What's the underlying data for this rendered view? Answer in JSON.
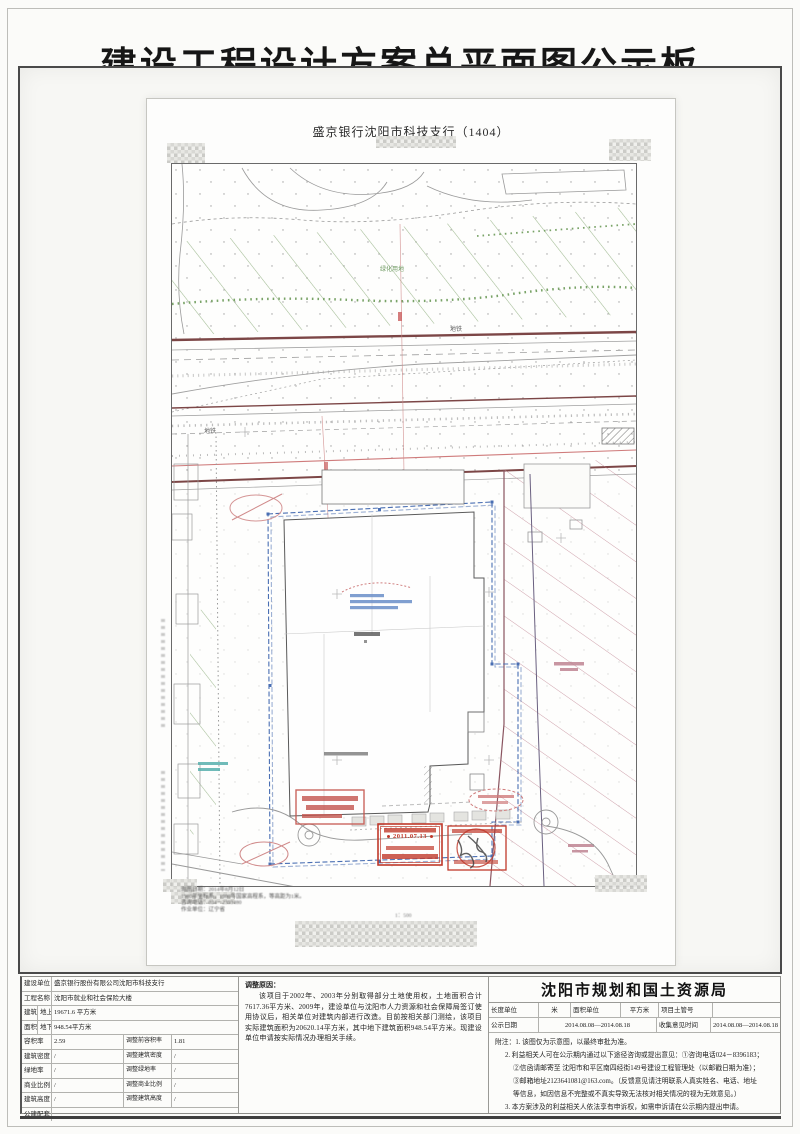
{
  "page": {
    "title": "建设工程设计方案总平面图公示板"
  },
  "sheet": {
    "title": "盛京银行沈阳市科技支行（1404）",
    "labels": {
      "metro_a": "地铁",
      "metro_b": "地铁",
      "green_area": "绿化用地"
    },
    "stamp_date": "2011.07.13",
    "scale_note": "1：500",
    "footnotes": [
      "测图日期：2014年8月12日",
      "1980年坐标系，1980年国家高程系，等高距为1米。",
      "咨询电话：024－2393480",
      "作业单位：辽宁省"
    ]
  },
  "info": {
    "rows": [
      {
        "label": "建设单位",
        "value": "盛京银行股份有限公司沈阳市科技支行"
      },
      {
        "label": "工程名称",
        "value": "沈阳市就业和社会保险大楼"
      }
    ],
    "area": {
      "top_label": "建筑",
      "bottom_label": "面积",
      "rows": [
        {
          "sub": "地上",
          "value": "19671.6 平方米"
        },
        {
          "sub": "地下",
          "value": "948.54平方米"
        }
      ]
    },
    "metrics": [
      {
        "label": "容积率",
        "value": "2.59",
        "adj_label": "调整前容积率",
        "adj_value": "1.81"
      },
      {
        "label": "建筑密度",
        "value": "/",
        "adj_label": "调整建筑密度",
        "adj_value": "/"
      },
      {
        "label": "绿地率",
        "value": "/",
        "adj_label": "调整绿地率",
        "adj_value": "/"
      },
      {
        "label": "商业比例",
        "value": "/",
        "adj_label": "调整商业比例",
        "adj_value": "/"
      },
      {
        "label": "建筑高度",
        "value": "/",
        "adj_label": "调整建筑高度",
        "adj_value": "/"
      }
    ],
    "footer_label": "公建配套",
    "footer_value": ""
  },
  "reason": {
    "title": "调整原因：",
    "body": "该项目于2002年、2003年分别取得部分土地使用权，土地面积合计7617.36平方米、2009年，建设单位与沈阳市人力资源和社会保障局签订使用协议后，相关单位对建筑内部进行改造。目前按相关部门测绘，该项目实际建筑面积为20620.14平方米，其中地下建筑面积948.54平方米。现建设单位申请按实际情况办理相关手续。"
  },
  "authority": {
    "title": "沈阳市规划和国土资源局",
    "units": {
      "length_label": "长度单位",
      "length_value": "米",
      "area_label": "面积单位",
      "area_value": "平方米",
      "project_label": "项目土管号",
      "project_value": ""
    },
    "dates": {
      "publish_label": "公示日期",
      "publish_value": "2014.08.08—2014.08.18",
      "collect_label": "收集意见时间",
      "collect_value": "2014.08.08—2014.08.18"
    },
    "notes": [
      "附注：1. 该图仅为示意图，以最终审批为准。",
      "2. 利益相关人可在公示期内通过以下途径咨询或提出意见：①咨询电话024－8396183；",
      "②信函请邮寄至 沈阳市和平区南四经街149号建设工程管理处（以邮戳日期为准）；",
      "③邮箱地址2123641081@163.com。（反馈意见请注明联系人真实姓名、电话、地址",
      "等信息，如因信息不完整或不真实导致无法核对相关情况的视为无效意见。）",
      "3. 本方案涉及的利益相关人依法享有申诉权，如需申诉请在公示期内提出申请。"
    ]
  },
  "colors": {
    "stamp_red": "#c0392b",
    "plan_blue": "#4a6fb3",
    "hatch_green": "#8fae7e",
    "hatch_pink": "#bf8492",
    "road_maroon": "#7c4646"
  }
}
